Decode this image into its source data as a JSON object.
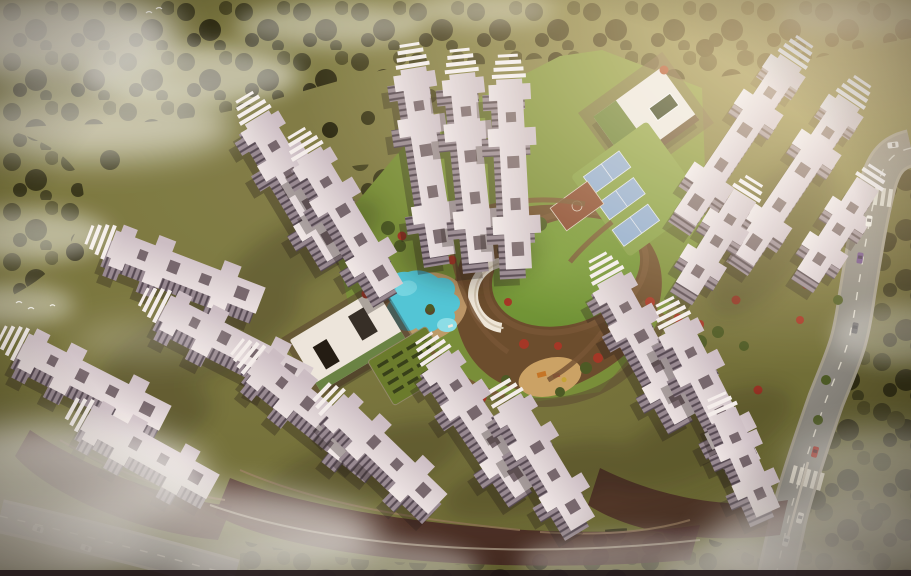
{
  "scene": {
    "title": "Aerial render of a high-rise residential township",
    "description": "Bird's-eye architectural rendering of about twenty cross-shaped white apartment towers arranged around a landscaped central courtyard. Amenities include a free-form cyan swimming pool with kids pool, two clubhouses with green roofs, three blue tennis courts, a basketball court, an oval lawn wrapped by a white amphitheatre ribbon, a children's playground and a hedge maze garden. Dense olive tree cover and drifting white clouds surround the site; an arterial road with cars and zebra crossings runs along the right edge and a service road crosses the lower-left corner. Warm late-afternoon light glows from the upper right.",
    "time_of_day": "warm late-afternoon light from the upper right",
    "counts": {
      "towers": 20,
      "tennis_courts": 3,
      "basketball_courts": 1,
      "swimming_pools": 2,
      "clubhouses": 2,
      "roads": 2,
      "cars": 9,
      "crosswalks": 2,
      "birds": 5
    },
    "vehicles": [
      "white",
      "white",
      "purple",
      "dark-grey",
      "red",
      "white",
      "silver",
      "silver",
      "white"
    ],
    "amenities": [
      "swimming pool",
      "kids pool",
      "clubhouse with green roof",
      "rooftop pool clubhouse",
      "tennis courts",
      "basketball court",
      "central oval lawn",
      "amphitheatre ribbon",
      "children playground",
      "hedge maze garden",
      "walking paths",
      "podium driveways"
    ]
  },
  "palette": {
    "ground_a": "#8f8c52",
    "ground_b": "#6e6d33",
    "ground_c": "#7a7540",
    "tree_a": "#3c3a1c",
    "tree_b": "#2f2c14",
    "tree_c": "#4a4722",
    "tower_facade": "#9b8d98",
    "facade_stripe": "#564a55",
    "crown": "#f8f4f6",
    "roof_detail": "#6e5e66",
    "tower_shadow": "#241c18",
    "podium": "#4b2b27",
    "plaza": "#6e4c2e",
    "path": "#7a5838",
    "drive": "#9a7d60",
    "courtyard": "#7b923c",
    "lawn_a": "#7da23e",
    "lawn_b": "#6b8f33",
    "lawn_c": "#84a046",
    "pool": "#54cbe0",
    "pool_light": "#8ee4f2",
    "deck": "#c7a172",
    "sand": "#cfa76a",
    "tennis": "#8fb0d6",
    "basketball": "#8a4a34",
    "club_roof": "#f1ece6",
    "green_roof": "#5d7c35",
    "club_dark": "#241c14",
    "road": "#8c8a84",
    "road_rim": "#a39d8f",
    "road_line": "#e9e5da",
    "flower": "#a83828",
    "shrub": "#4e5c26",
    "cloud": "#ffffff",
    "glow": "#ffe2b0",
    "vignette": "#20160a",
    "border_strip": "#1c1014",
    "car_white": "#f2f0ea",
    "car_silver": "#c9c9c9",
    "car_purple": "#6a4a8a",
    "car_red": "#a32c22",
    "car_dark": "#4a4a50"
  }
}
